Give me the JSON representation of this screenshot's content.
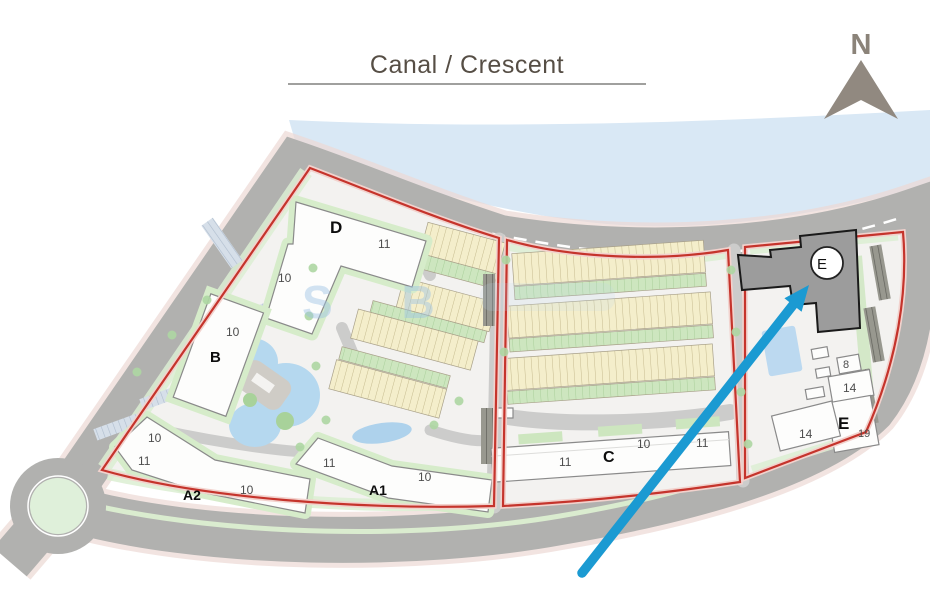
{
  "title": {
    "text": "Canal / Crescent"
  },
  "compass": {
    "label": "N"
  },
  "watermark": {
    "text": "S B"
  },
  "map": {
    "buildings": {
      "d": {
        "letter": "D",
        "unit_top": "11",
        "unit_left": "10"
      },
      "b": {
        "letter": "B",
        "unit": "10"
      },
      "a2": {
        "letter": "A2",
        "unit_nw_top": "10",
        "unit_nw": "11",
        "unit_e": "10"
      },
      "a1": {
        "letter": "A1",
        "unit_w": "11",
        "unit_e": "10"
      },
      "c": {
        "letter": "C",
        "unit_w": "11",
        "unit_mid": "10",
        "unit_e": "11"
      },
      "e_tower": {
        "letter": "E"
      },
      "e_lowrise": {
        "letter": "E",
        "unit_8": "8",
        "unit_14_upper": "14",
        "unit_19": "19",
        "unit_14_left": "14"
      }
    },
    "colors": {
      "water": "#d9e8f5",
      "road": "#b1b1af",
      "boundary": "#c5342c",
      "arrow": "#1b9ad2",
      "townhouse": "#f4eecb",
      "green": "#d5ebca"
    }
  }
}
